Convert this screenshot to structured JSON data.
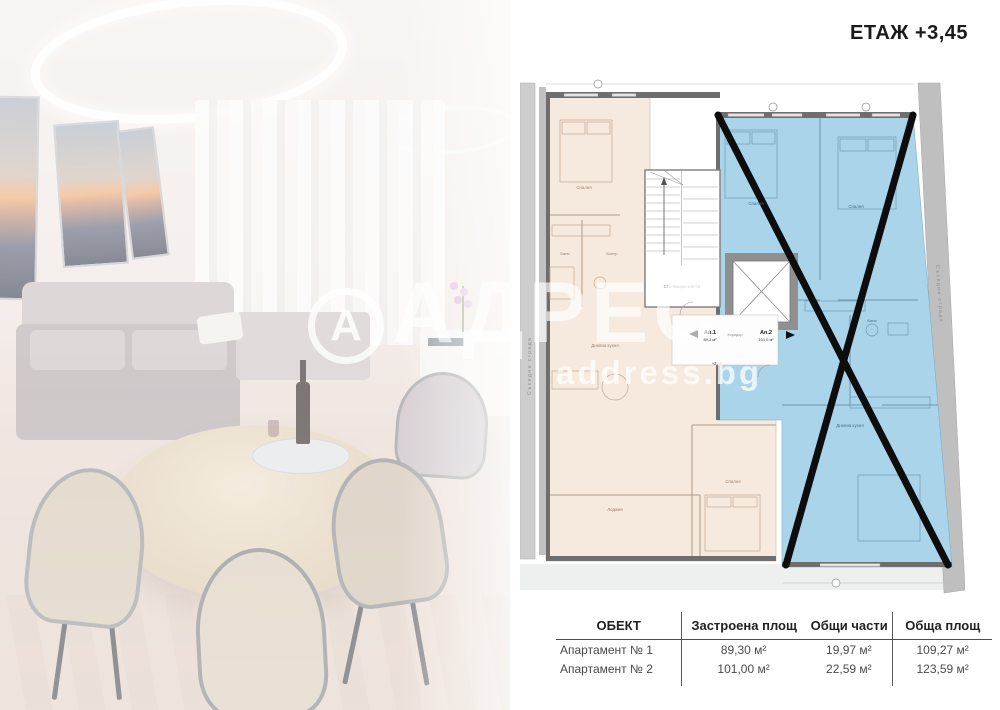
{
  "header": {
    "floor_label": "ЕТАЖ +3,45"
  },
  "watermark": {
    "logo_letter": "А",
    "brand": "АДРЕС",
    "site": "address.bg"
  },
  "plan": {
    "apartments": {
      "ap1_label": "Ап.1",
      "ap1_area": "89,3 м²",
      "ap2_label": "Ап.2",
      "ap2_area": "101,0 м²"
    },
    "labels": {
      "stairwell": "Стълбищна клетка",
      "corridor": "Коридор",
      "level": "+3,45",
      "bedroom": "Спалня",
      "bath": "Баня",
      "closet": "Килер",
      "living_kitchen": "Дневна кухня",
      "loggia": "Лоджия",
      "neighbor_left": "Съседна сграда",
      "neighbor_right": "Съседна сграда"
    },
    "colors": {
      "apartment1_fill": "#f6e9dd",
      "apartment2_fill": "#a9d4e9",
      "wall_gray": "#6e6e6e",
      "cross_black": "#0d0d0d"
    }
  },
  "table": {
    "headers": [
      "ОБЕКТ",
      "Застроена площ",
      "Общи части",
      "Обща площ"
    ],
    "rows": [
      {
        "name": "Апартамент № 1",
        "built": "89,30 м²",
        "common": "19,97 м²",
        "total": "109,27 м²"
      },
      {
        "name": "Апартамент № 2",
        "built": "101,00 м²",
        "common": "22,59 м²",
        "total": "123,59 м²"
      }
    ]
  }
}
